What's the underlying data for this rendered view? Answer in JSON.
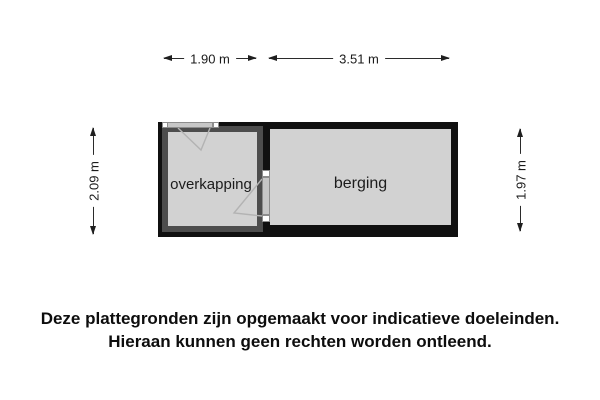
{
  "floor_plan": {
    "rooms": [
      {
        "label": "overkapping"
      },
      {
        "label": "berging"
      }
    ],
    "dimensions": {
      "top_left": "1.90 m",
      "top_right": "3.51 m",
      "left": "2.09 m",
      "right": "1.97 m"
    },
    "colors": {
      "outer_wall": "#101010",
      "inner_wall": "#4d4d4d",
      "floor": "#d2d2d2",
      "door": "#c7c7c7",
      "swing_line": "#b3b3b3",
      "dimension_line": "#2b2b2b"
    }
  },
  "disclaimer": {
    "line1": "Deze plattegronden zijn opgemaakt voor indicatieve doeleinden.",
    "line2": "Hieraan kunnen geen rechten worden ontleend."
  }
}
